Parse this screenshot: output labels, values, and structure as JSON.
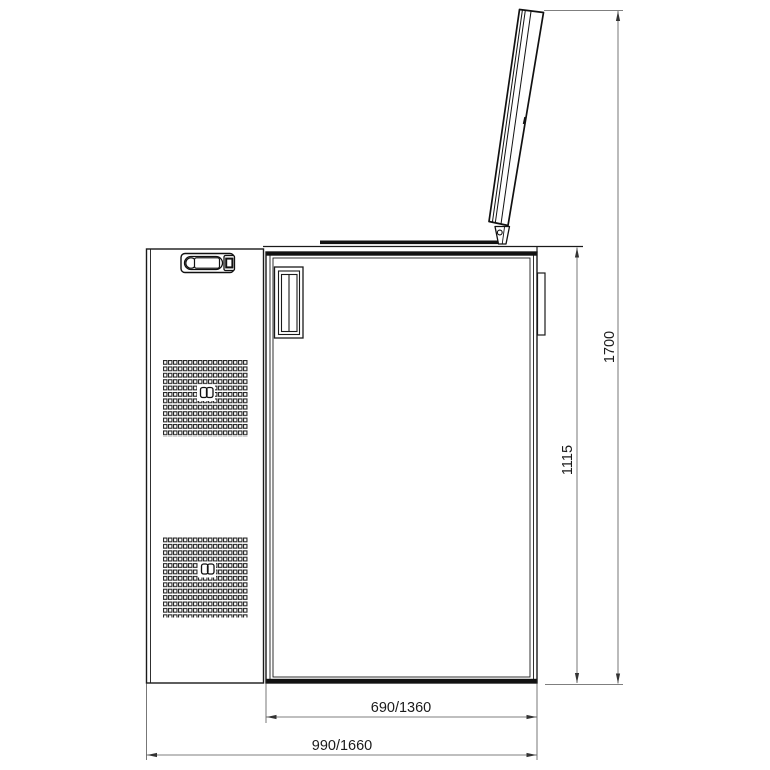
{
  "figure": {
    "type": "technical-drawing",
    "dim_labels": {
      "door_width": "690/1360",
      "overall_width": "990/1660",
      "body_height": "1115",
      "overall_height": "1700"
    },
    "colors": {
      "object_line": "#1a1a1a",
      "dark_band": "#111111",
      "dimension_line": "#555555",
      "arrow_fill": "#333333",
      "background": "#ffffff"
    }
  }
}
